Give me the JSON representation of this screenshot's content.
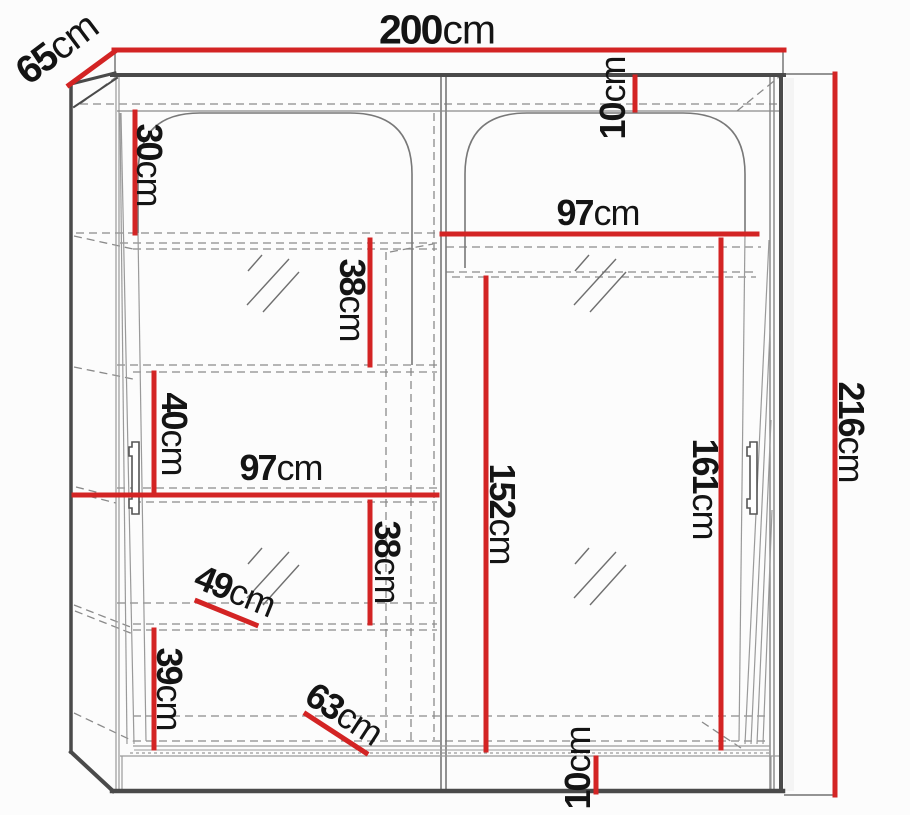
{
  "diagram": {
    "kind": "wardrobe-dimension-diagram",
    "unit": "cm"
  },
  "colors": {
    "dimension": "#d32424",
    "outline": "#4a4a4a",
    "line": "#8a8a8a",
    "text": "#141414",
    "background": "#fcfcfc"
  },
  "dimensions": {
    "width": {
      "num": "200",
      "unit": "cm"
    },
    "depth": {
      "num": "65",
      "unit": "cm"
    },
    "height": {
      "num": "216",
      "unit": "cm"
    },
    "top_inset": {
      "num": "10",
      "unit": "cm"
    },
    "shelf_30": {
      "num": "30",
      "unit": "cm"
    },
    "right_width": {
      "num": "97",
      "unit": "cm"
    },
    "shelf_38_up": {
      "num": "38",
      "unit": "cm"
    },
    "shelf_40": {
      "num": "40",
      "unit": "cm"
    },
    "left_width": {
      "num": "97",
      "unit": "cm"
    },
    "shelf_38_low": {
      "num": "38",
      "unit": "cm"
    },
    "shelf_depth_49": {
      "num": "49",
      "unit": "cm"
    },
    "shelf_39": {
      "num": "39",
      "unit": "cm"
    },
    "hang_152": {
      "num": "152",
      "unit": "cm"
    },
    "hang_161": {
      "num": "161",
      "unit": "cm"
    },
    "bottom_depth_63": {
      "num": "63",
      "unit": "cm"
    },
    "plinth_10": {
      "num": "10",
      "unit": "cm"
    }
  }
}
